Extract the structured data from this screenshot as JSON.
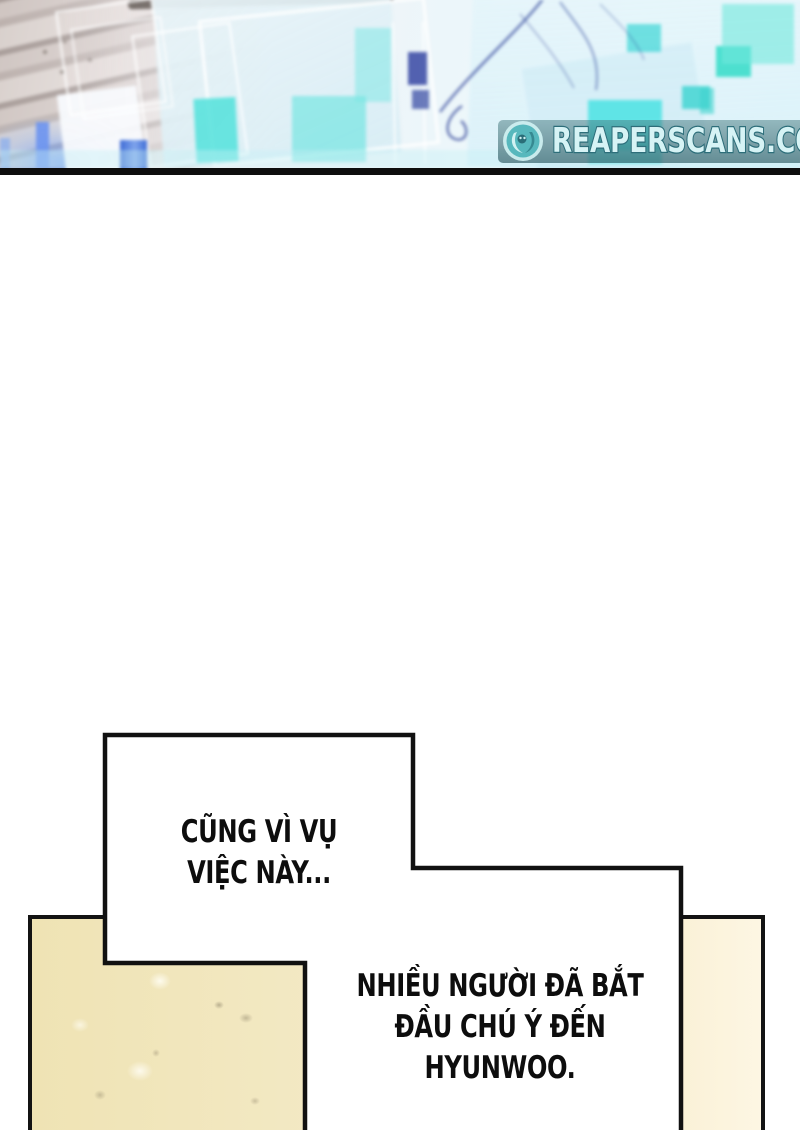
{
  "watermark": {
    "text": "REAPERSCANS.COM",
    "icon": "reaper-logo-icon",
    "banner_color": "#2c6b76",
    "text_color": "#d6f3f5"
  },
  "colors": {
    "separator": "#0e0e0e",
    "bubble_fill": "#ffffff",
    "bubble_border": "#111111",
    "panel_fill": "#f3e9c4",
    "panel_border": "#131313",
    "art_cyan_accent": "#4fe0dc",
    "art_blue_accent": "#6b94f0"
  },
  "speech_bubbles": [
    {
      "lines": [
        "CŨNG VÌ VỤ",
        "VIỆC NÀY..."
      ]
    },
    {
      "lines": [
        "NHIỀU NGƯỜI ĐÃ BẮT",
        "ĐẦU CHÚ Ý ĐẾN",
        "HYUNWOO."
      ]
    }
  ]
}
